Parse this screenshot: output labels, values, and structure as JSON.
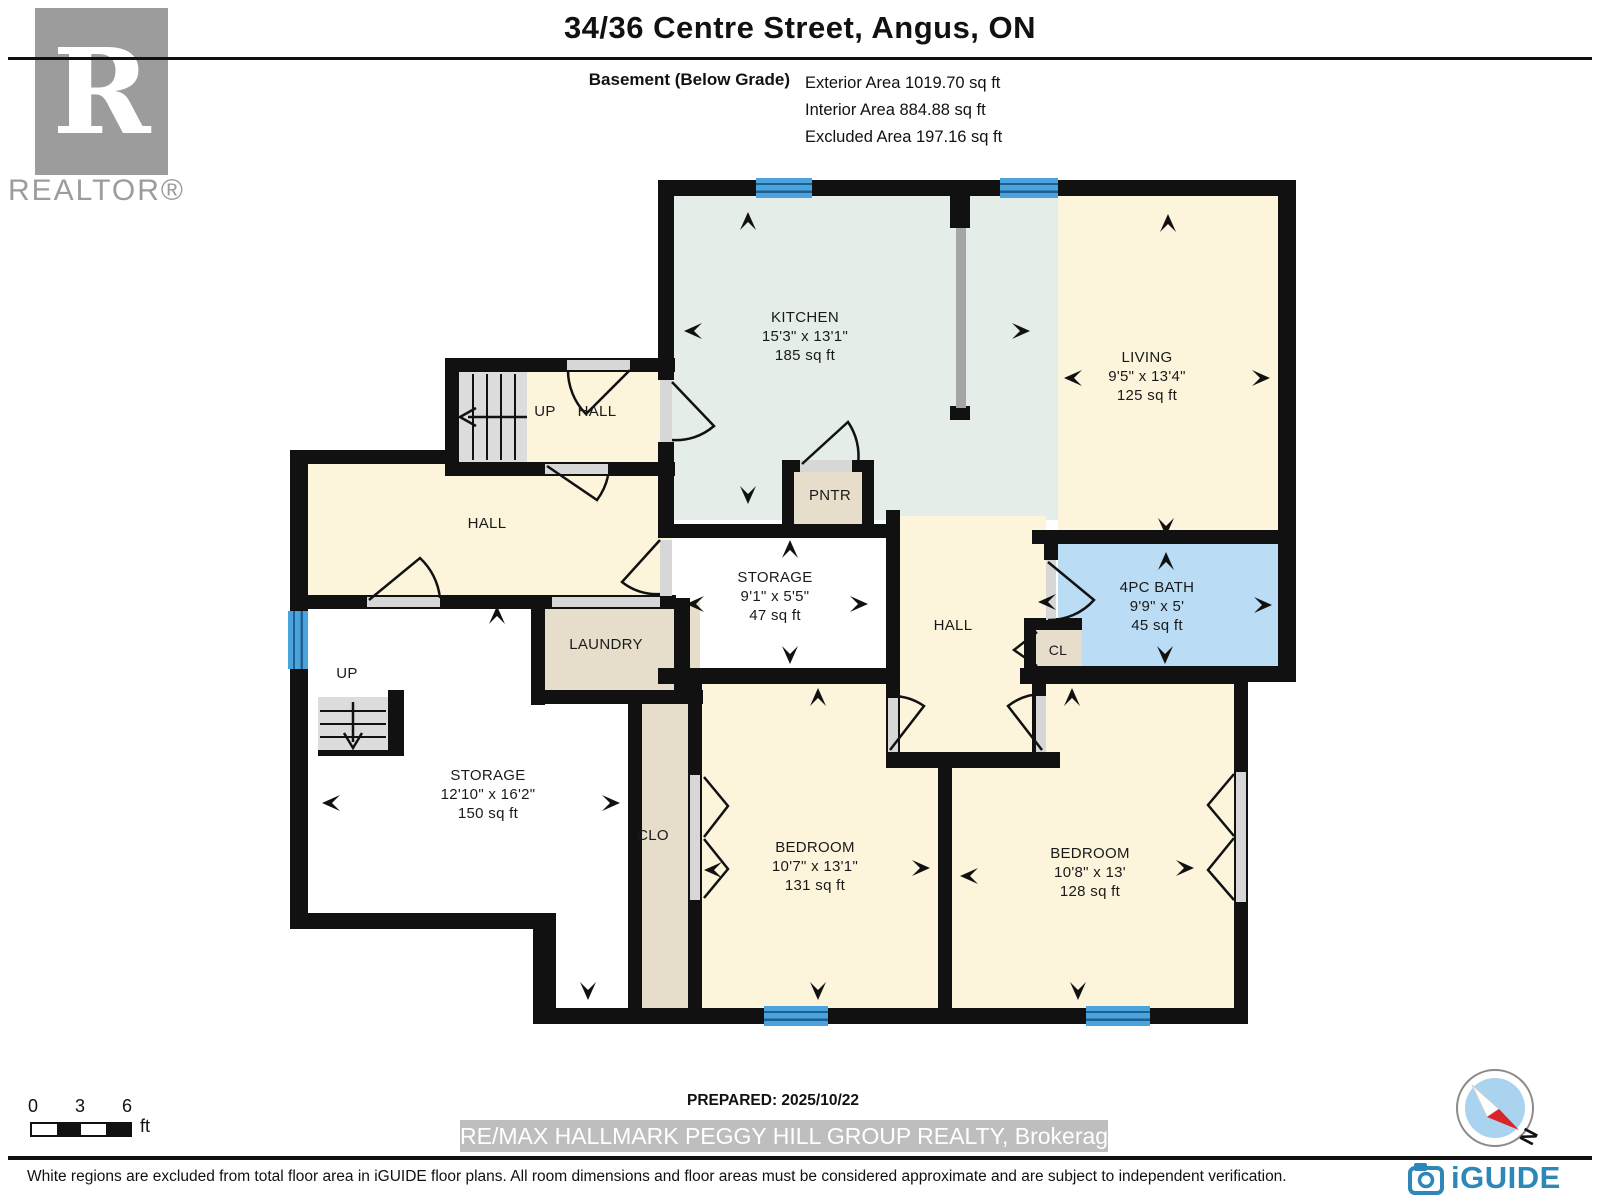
{
  "header": {
    "title": "34/36 Centre Street, Angus, ON",
    "floor_label": "Basement (Below Grade)",
    "exterior_area": "Exterior Area 1019.70 sq ft",
    "interior_area": "Interior Area 884.88 sq ft",
    "excluded_area": "Excluded Area 197.16 sq ft"
  },
  "branding": {
    "realtor_logo_letter": "R",
    "realtor_logo_text": "REALTOR®",
    "iguide_logo_text": "iGUIDE",
    "compass_north_label": "N"
  },
  "rooms": {
    "kitchen": {
      "name": "KITCHEN",
      "dims": "15'3\" x 13'1\"",
      "area": "185 sq ft"
    },
    "living": {
      "name": "LIVING",
      "dims": "9'5\" x 13'4\"",
      "area": "125 sq ft"
    },
    "bath": {
      "name": "4PC BATH",
      "dims": "9'9\" x 5'",
      "area": "45 sq ft"
    },
    "storage_small": {
      "name": "STORAGE",
      "dims": "9'1\" x 5'5\"",
      "area": "47 sq ft"
    },
    "storage_large": {
      "name": "STORAGE",
      "dims": "12'10\" x 16'2\"",
      "area": "150 sq ft"
    },
    "bedroom_left": {
      "name": "BEDROOM",
      "dims": "10'7\" x 13'1\"",
      "area": "131 sq ft"
    },
    "bedroom_right": {
      "name": "BEDROOM",
      "dims": "10'8\" x 13'",
      "area": "128 sq ft"
    },
    "hall_upper": {
      "name": "HALL"
    },
    "hall_main": {
      "name": "HALL"
    },
    "hall_central": {
      "name": "HALL"
    },
    "laundry": {
      "name": "LAUNDRY"
    },
    "pantry": {
      "name": "PNTR"
    },
    "closet_small": {
      "name": "CL"
    },
    "closet_long": {
      "name": "CLO"
    },
    "stairs_upper_label": "UP",
    "stairs_lower_label": "UP"
  },
  "scale_bar": {
    "tick0": "0",
    "tick1": "3",
    "tick2": "6",
    "unit": "ft"
  },
  "footer": {
    "prepared": "PREPARED: 2025/10/22",
    "watermark": "RE/MAX HALLMARK PEGGY HILL GROUP REALTY, Brokerage",
    "disclaimer": "White regions are excluded from total floor area in iGUIDE floor plans. All room dimensions and floor areas must be considered approximate and are subject to independent verification."
  },
  "colors": {
    "wall": "#111111",
    "room_cream": "#fcf5dc",
    "room_mint": "#e4ede7",
    "room_blue": "#badcf5",
    "room_tan": "#e7ddcb",
    "window_blue": "#4aa3dd",
    "door_gray": "#d7d7d7",
    "stair_gray": "#dcdcdc",
    "iguide_blue": "#2d87b9"
  }
}
